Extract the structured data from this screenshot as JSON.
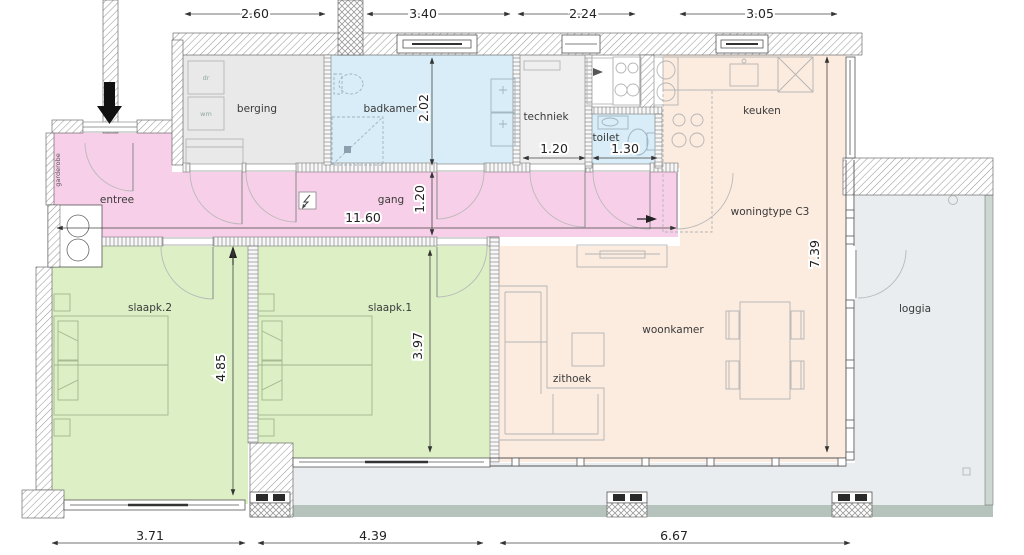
{
  "title": "woningtype C3",
  "labels": {
    "berging": "berging",
    "badkamer": "badkamer",
    "techniek": "techniek",
    "toilet": "toilet",
    "keuken": "keuken",
    "entree": "entree",
    "gang": "gang",
    "garderobe": "garderobe",
    "slaapk2": "slaapk.2",
    "slaapk1": "slaapk.1",
    "woonkamer": "woonkamer",
    "zithoek": "zithoek",
    "loggia": "loggia",
    "woningtype": "woningtype C3",
    "dryer": "dr",
    "washer": "wm"
  },
  "dimensions": {
    "top": [
      "2.60",
      "3.40",
      "2.24",
      "3.05"
    ],
    "bottom": [
      "3.71",
      "4.39",
      "6.67"
    ],
    "badkamer_depth": "2.02",
    "gang_width": "1.20",
    "gang_length": "11.60",
    "techniek_width": "1.20",
    "toilet_width": "1.30",
    "woonkamer_depth": "7.39",
    "slaapk2_depth": "4.85",
    "slaapk1_depth": "3.97"
  },
  "colors": {
    "hallway": "#f8cfe8",
    "bedroom": "#dcefc5",
    "living": "#fcebdf",
    "bathroom": "#d8edf7",
    "storage": "#e9e9e9",
    "techniek_room": "#efefef",
    "loggia": "#e9edef",
    "terrace_band": "#b6c2bc",
    "railing": "#ccd7d1"
  }
}
